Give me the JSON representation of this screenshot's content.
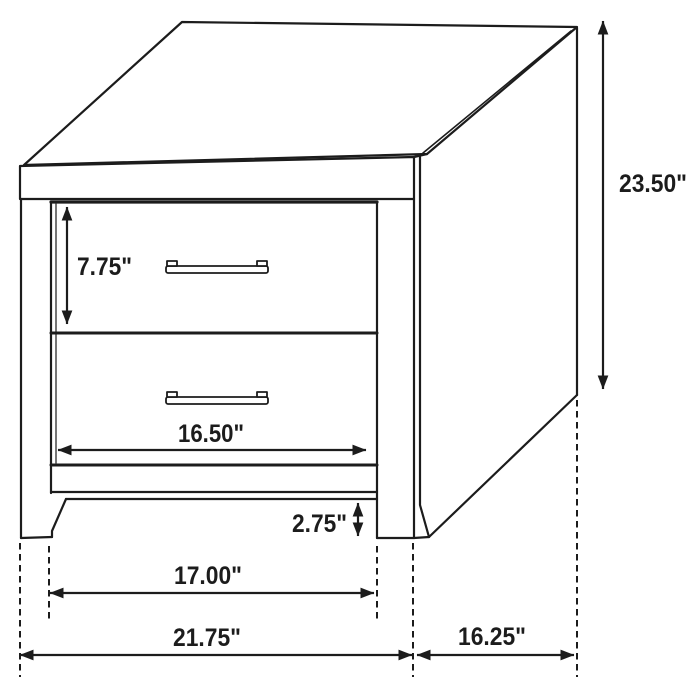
{
  "diagram": {
    "subject": "Two-drawer nightstand technical dimension drawing",
    "colors": {
      "line": "#1c1c1c",
      "background": "#ffffff"
    },
    "dimensions": {
      "overall_height": "23.50\"",
      "top_drawer_height": "7.75\"",
      "drawer_width": "16.50\"",
      "base_clearance": "2.75\"",
      "leg_inner_span": "17.00\"",
      "overall_width": "21.75\"",
      "overall_depth": "16.25\""
    }
  }
}
